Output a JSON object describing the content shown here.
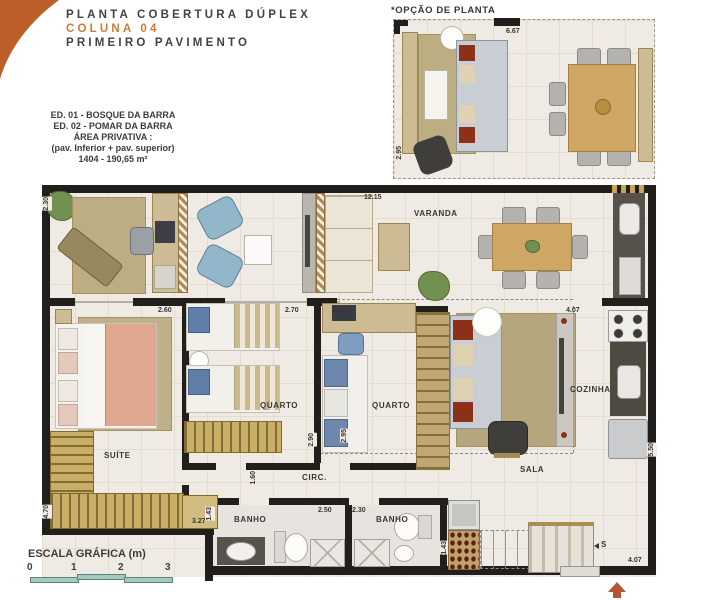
{
  "header": {
    "line1": "PLANTA COBERTURA DÚPLEX",
    "line2": "COLUNA 04",
    "line3": "PRIMEIRO PAVIMENTO"
  },
  "info": {
    "line1": "ED. 01 - BOSQUE DA BARRA",
    "line2": "ED. 02 - POMAR DA BARRA",
    "line3": "ÁREA PRIVATIVA :",
    "line4": "(pav. Inferior + pav. superior)",
    "line5": "1404 - 190,65 m²"
  },
  "option_plan": {
    "title": "*OPÇÃO DE PLANTA",
    "dim_width": "6.67",
    "dim_height": "2.95"
  },
  "rooms": {
    "varanda": "VARANDA",
    "suite": "SUÍTE",
    "quarto1": "QUARTO",
    "quarto2": "QUARTO",
    "sala": "SALA",
    "cozinha": "COZINHA",
    "circ": "CIRC.",
    "banho1": "BANHO",
    "banho2": "BANHO"
  },
  "dims": {
    "top_width": "12.15",
    "left_height": "2.30",
    "suite_width": "2.60",
    "quarto1_width": "2.70",
    "quarto2_width": "2.60",
    "sala_width": "4.07",
    "quarto1_height": "2.90",
    "quarto2_height": "2.95",
    "cozinha_height": "5.50",
    "closet_height": "4.70",
    "closet_width": "3.27",
    "circ_width": "1.60",
    "banho1_height": "1.43",
    "banho1_width": "2.50",
    "banho2_width": "2.30",
    "banho2_height": "1.43",
    "entry_width": "4.07"
  },
  "stairs": {
    "label": "S"
  },
  "scale": {
    "title": "ESCALA GRÁFICA (m)",
    "ticks": [
      "0",
      "1",
      "2",
      "3"
    ]
  },
  "colors": {
    "accent_orange": "#bd5f28",
    "wall": "#221e1b",
    "floor": "#efeae3",
    "tan": "#c9ae66",
    "scale_teal": "#a4c9c2"
  }
}
